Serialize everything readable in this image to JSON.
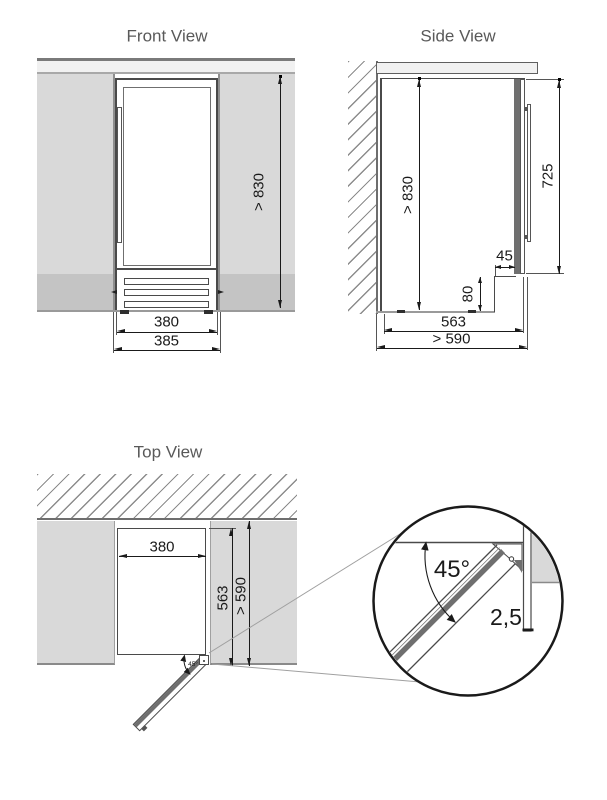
{
  "front_view": {
    "title": "Front View",
    "dim_height": "> 830",
    "dim_width_inner": "380",
    "dim_width_outer": "385"
  },
  "side_view": {
    "title": "Side View",
    "dim_height": "> 830",
    "dim_door_height": "725",
    "dim_recess_depth": "45",
    "dim_recess_height": "80",
    "dim_depth": "563",
    "dim_total_depth": "> 590"
  },
  "top_view": {
    "title": "Top View",
    "dim_width": "380",
    "dim_depth": "563",
    "dim_total_depth": "> 590",
    "door_angle": "45°"
  },
  "detail_view": {
    "door_angle": "45°",
    "dim_gap": "2,5"
  },
  "colors": {
    "wall": "#d9d9d9",
    "plinth": "#c4c4c4",
    "countertop": "#f1f1f1",
    "outline": "#4a4a4a",
    "door_gray": "#6f6f6f",
    "hatch": "#8c8c8c",
    "dimension": "#1a1a1a",
    "title_text": "#595959",
    "leader_line": "#a0a0a0"
  }
}
